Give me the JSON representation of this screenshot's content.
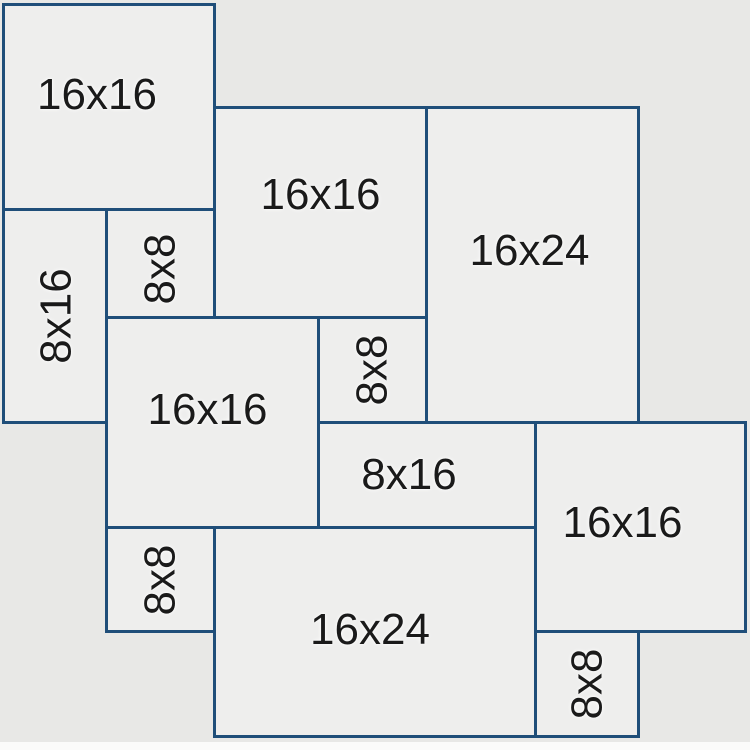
{
  "diagram": {
    "description": "Paver pattern layout diagram",
    "canvas": {
      "width": 750,
      "height": 750
    },
    "colors": {
      "background": "#e8e8e6",
      "tile_fill": "#eeeeed",
      "border": "#1f4e79",
      "label": "#1a1a1a",
      "bottom_strip": "#fbfbfa"
    },
    "border_width_px": 3,
    "label_font_size_px": 44,
    "tiles": [
      {
        "id": "16x16-top-left",
        "label": "16x16",
        "x": 2,
        "y": 3,
        "w": 214,
        "h": 208,
        "rotated": false,
        "dx": -12,
        "dy": -12
      },
      {
        "id": "16x16-upper-middle",
        "label": "16x16",
        "x": 213,
        "y": 106,
        "w": 215,
        "h": 213,
        "rotated": false,
        "dx": 0,
        "dy": -18
      },
      {
        "id": "16x24-upper-right",
        "label": "16x24",
        "x": 425,
        "y": 106,
        "w": 215,
        "h": 318,
        "rotated": false,
        "dx": -3,
        "dy": -14
      },
      {
        "id": "8x8-upper",
        "label": "8x8",
        "x": 105,
        "y": 208,
        "w": 111,
        "h": 111,
        "rotated": true,
        "dx": 0,
        "dy": 5
      },
      {
        "id": "8x16-left",
        "label": "8x16",
        "x": 2,
        "y": 208,
        "w": 106,
        "h": 216,
        "rotated": true,
        "dx": 2,
        "dy": 0
      },
      {
        "id": "16x16-center",
        "label": "16x16",
        "x": 105,
        "y": 316,
        "w": 215,
        "h": 213,
        "rotated": false,
        "dx": -5,
        "dy": -13
      },
      {
        "id": "8x8-middle",
        "label": "8x8",
        "x": 317,
        "y": 316,
        "w": 111,
        "h": 108,
        "rotated": true,
        "dx": 0,
        "dy": 0
      },
      {
        "id": "8x16-middle",
        "label": "8x16",
        "x": 317,
        "y": 421,
        "w": 220,
        "h": 108,
        "rotated": false,
        "dx": -18,
        "dy": 0
      },
      {
        "id": "16x16-right",
        "label": "16x16",
        "x": 534,
        "y": 421,
        "w": 213,
        "h": 212,
        "rotated": false,
        "dx": -18,
        "dy": -4
      },
      {
        "id": "8x8-lower-left",
        "label": "8x8",
        "x": 105,
        "y": 526,
        "w": 111,
        "h": 107,
        "rotated": true,
        "dx": 0,
        "dy": 0
      },
      {
        "id": "16x24-bottom",
        "label": "16x24",
        "x": 213,
        "y": 526,
        "w": 324,
        "h": 212,
        "rotated": false,
        "dx": -5,
        "dy": -2
      },
      {
        "id": "8x8-bottom-right",
        "label": "8x8",
        "x": 534,
        "y": 630,
        "w": 106,
        "h": 108,
        "rotated": true,
        "dx": 0,
        "dy": 0
      }
    ]
  }
}
